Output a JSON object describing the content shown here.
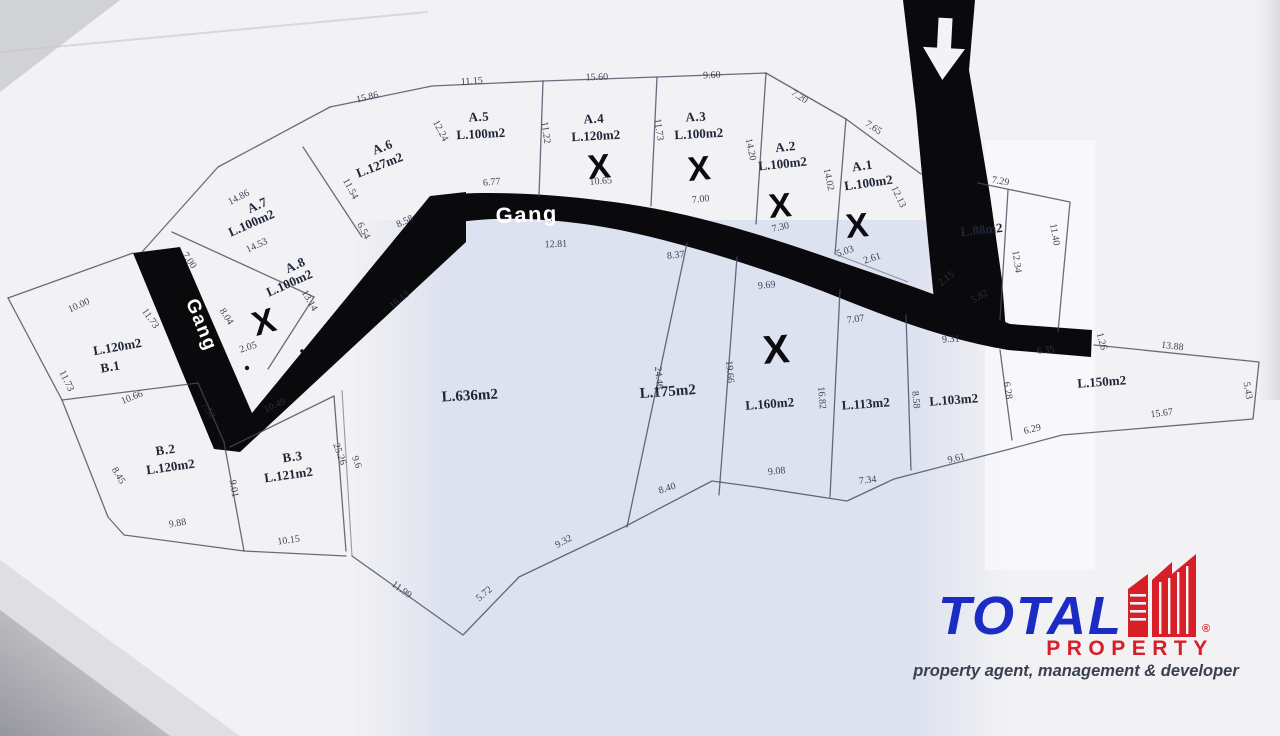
{
  "map": {
    "road_label_main": "Gang",
    "road_label_side": "Gang",
    "x_mark": "X",
    "plots": [
      {
        "name": "A.5",
        "area": "L.100m2"
      },
      {
        "name": "A.4",
        "area": "L.120m2"
      },
      {
        "name": "A.3",
        "area": "L.100m2"
      },
      {
        "name": "A.2",
        "area": "L.100m2"
      },
      {
        "name": "A.1",
        "area": "L.100m2"
      },
      {
        "name": "A.6",
        "area": "L.127m2"
      },
      {
        "name": "A.7",
        "area": "L.100m2"
      },
      {
        "name": "A.8",
        "area": "L.100m2"
      },
      {
        "name": "B.1",
        "area": "L.120m2"
      },
      {
        "name": "B.2",
        "area": "L.120m2"
      },
      {
        "name": "B.3",
        "area": "L.121m2"
      },
      {
        "name": "",
        "area": "L.636m2"
      },
      {
        "name": "",
        "area": "L.175m2"
      },
      {
        "name": "",
        "area": "L.160m2"
      },
      {
        "name": "",
        "area": "L.113m2"
      },
      {
        "name": "",
        "area": "L.103m2"
      },
      {
        "name": "",
        "area": "L.150m2"
      },
      {
        "name": "",
        "area": "L.88m2"
      }
    ],
    "dimensions": [
      "15.86",
      "11.15",
      "15.60",
      "9.60",
      "7.20",
      "7.65",
      "7.29",
      "11.40",
      "12.34",
      "12.13",
      "14.20",
      "14.02",
      "11.22",
      "11.73",
      "12.24",
      "6.77",
      "10.65",
      "7.00",
      "7.30",
      "5.03",
      "2.61",
      "2.15",
      "5.82",
      "14.86",
      "7.00",
      "14.53",
      "11.54",
      "6.54",
      "8.58",
      "13.14",
      "8.04",
      "2.05",
      "16.13",
      "10.00",
      "11.73",
      "10.66",
      "7.52",
      "10.49",
      "8.45",
      "9.01",
      "9.88",
      "10.15",
      "25.26",
      "9.6",
      "11.99",
      "5.72",
      "9.32",
      "8.40",
      "9.08",
      "7.34",
      "9.61",
      "6.29",
      "15.67",
      "5.43",
      "13.88",
      "6.35",
      "9.31",
      "6.28",
      "12.81",
      "8.37",
      "24.46",
      "19.66",
      "16.82",
      "8.58",
      "9.69",
      "7.07",
      "11.73",
      "1.26"
    ]
  },
  "logo": {
    "brand": "TOTAL",
    "brand2": "PROPERTY",
    "registered": "®",
    "tagline": "property agent, management & developer",
    "colors": {
      "blue": "#1b2cc5",
      "red": "#d81f28",
      "dark": "#394050"
    }
  }
}
